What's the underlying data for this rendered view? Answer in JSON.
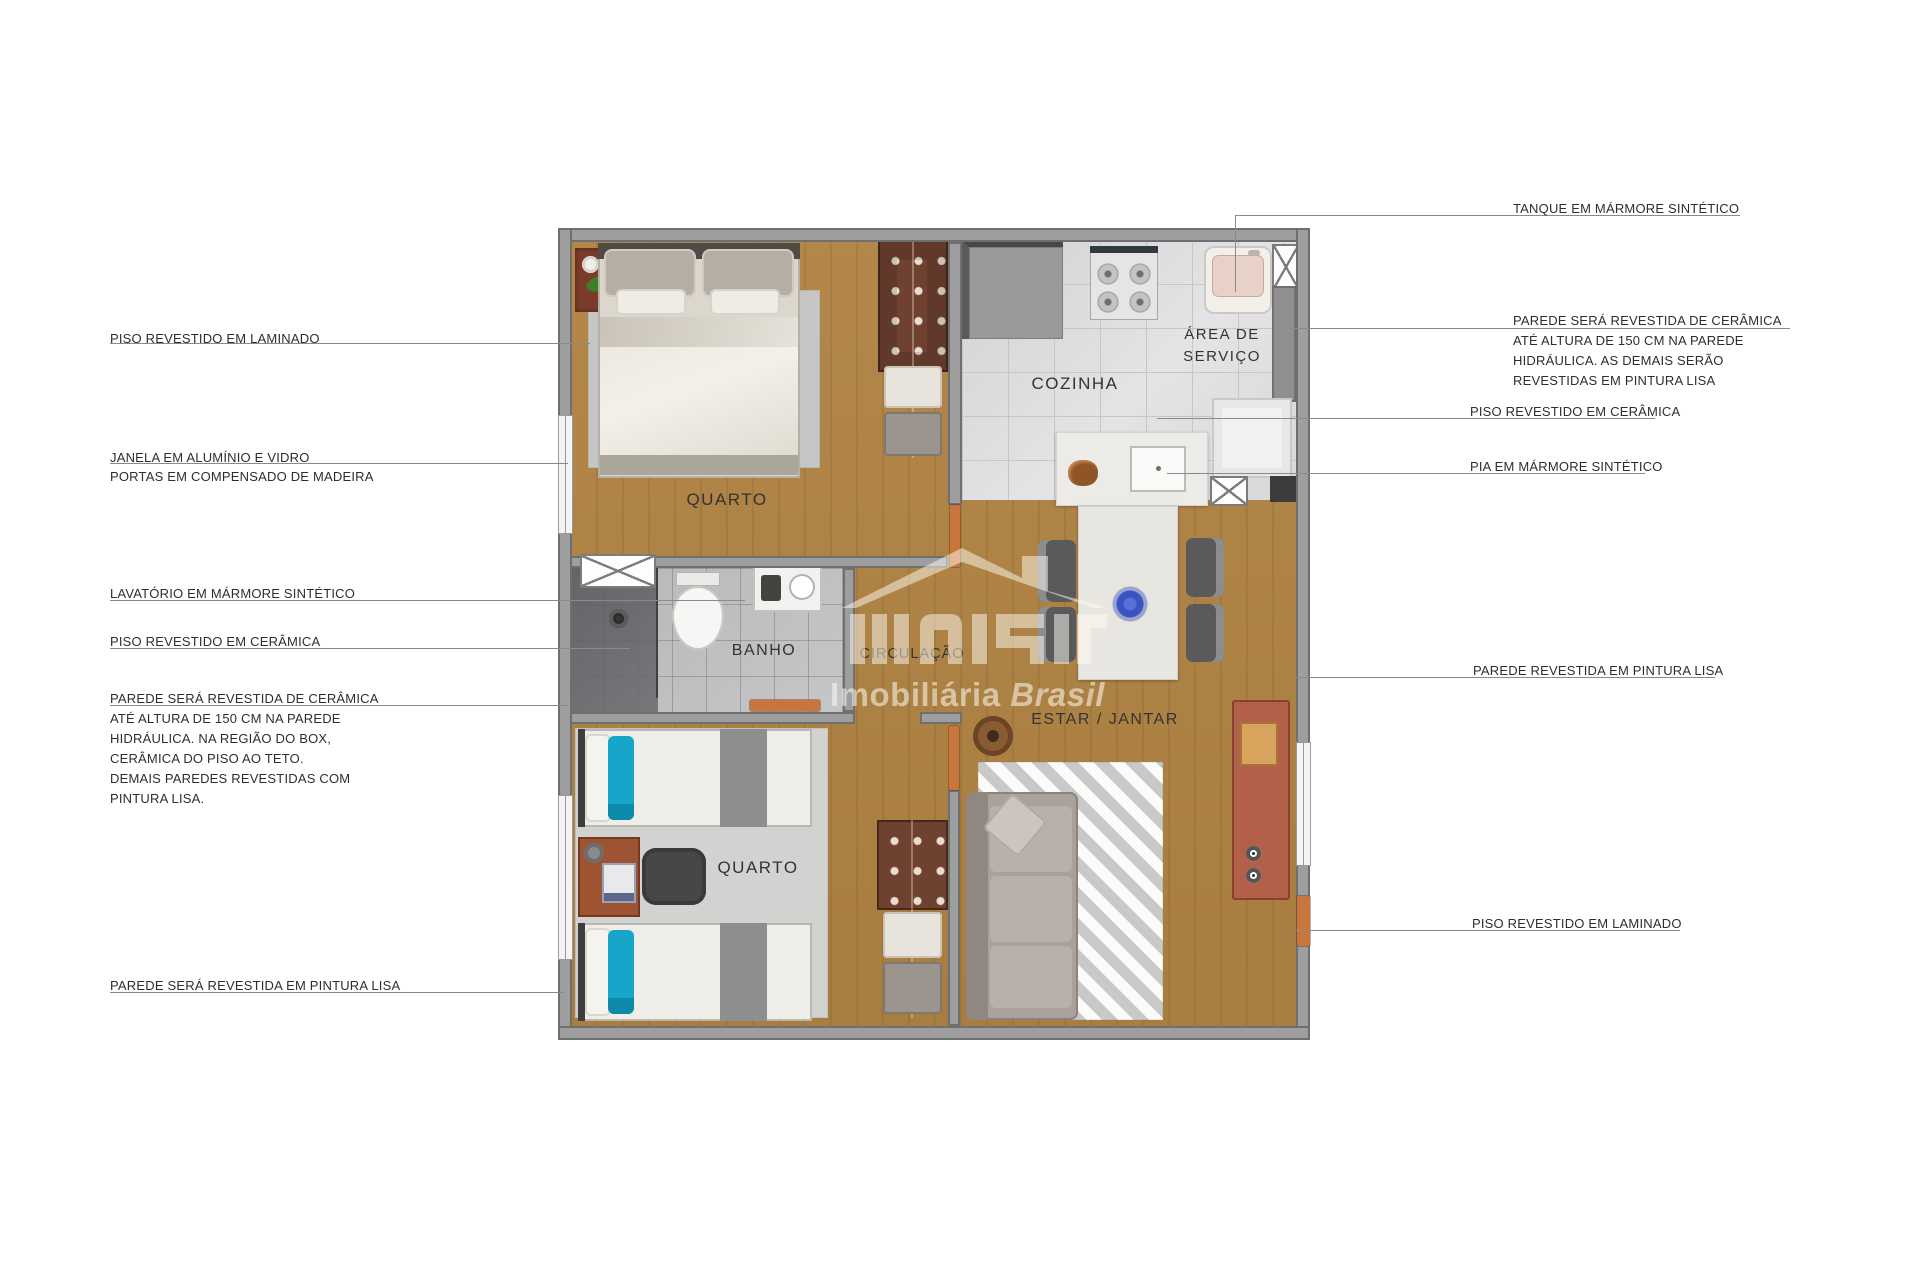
{
  "watermark": {
    "brand": "Imobiliária",
    "brand_italic": "Brasil"
  },
  "rooms": {
    "quarto_top": "QUARTO",
    "cozinha": "COZINHA",
    "area_servico_line1": "ÁREA DE",
    "area_servico_line2": "SERVIÇO",
    "banho": "BANHO",
    "circulacao": "CIRCULAÇÃO",
    "estar_jantar": "ESTAR / JANTAR",
    "quarto_bottom": "QUARTO"
  },
  "annotations": {
    "left": {
      "piso_laminado": {
        "lines": [
          "PISO REVESTIDO EM LAMINADO"
        ]
      },
      "janela_portas": {
        "lines": [
          "JANELA EM ALUMÍNIO E VIDRO",
          "PORTAS EM COMPENSADO DE MADEIRA"
        ]
      },
      "lavatorio": {
        "lines": [
          "LAVATÓRIO EM MÁRMORE SINTÉTICO"
        ]
      },
      "piso_ceramica": {
        "lines": [
          "PISO REVESTIDO EM CERÂMICA"
        ]
      },
      "parede_ceramica": {
        "lines": [
          "PAREDE SERÁ REVESTIDA DE CERÂMICA",
          "ATÉ ALTURA DE 150 CM NA PAREDE",
          "HIDRÁULICA. NA REGIÃO DO BOX,",
          "CERÂMICA DO PISO AO TETO.",
          "DEMAIS PAREDES REVESTIDAS COM",
          "PINTURA LISA."
        ]
      },
      "parede_pintura": {
        "lines": [
          "PAREDE SERÁ REVESTIDA EM PINTURA LISA"
        ]
      }
    },
    "right": {
      "tanque": {
        "lines": [
          "TANQUE EM MÁRMORE SINTÉTICO"
        ]
      },
      "parede_ceramica": {
        "lines": [
          "PAREDE SERÁ REVESTIDA DE CERÂMICA",
          "ATÉ ALTURA DE 150 CM NA PAREDE",
          "HIDRÁULICA. AS DEMAIS SERÃO",
          "REVESTIDAS EM PINTURA LISA"
        ]
      },
      "piso_ceramica": {
        "lines": [
          "PISO REVESTIDO EM CERÂMICA"
        ]
      },
      "pia": {
        "lines": [
          "PIA EM MÁRMORE SINTÉTICO"
        ]
      },
      "parede_pintura": {
        "lines": [
          "PAREDE REVESTIDA EM PINTURA LISA"
        ]
      },
      "piso_laminado": {
        "lines": [
          "PISO REVESTIDO EM LAMINADO"
        ]
      }
    }
  },
  "colors": {
    "wood_floor": "#ad8147",
    "kitchen_tile": "#dcdcde",
    "bath_tile": "#b7b7ba",
    "wall_gray": "#9e9e9e",
    "pillow_blue": "#17a5c9",
    "door_wood": "#c8763d",
    "flower_blue": "#3b55c0",
    "watermark_cream": "rgba(255,252,244,0.55)"
  }
}
